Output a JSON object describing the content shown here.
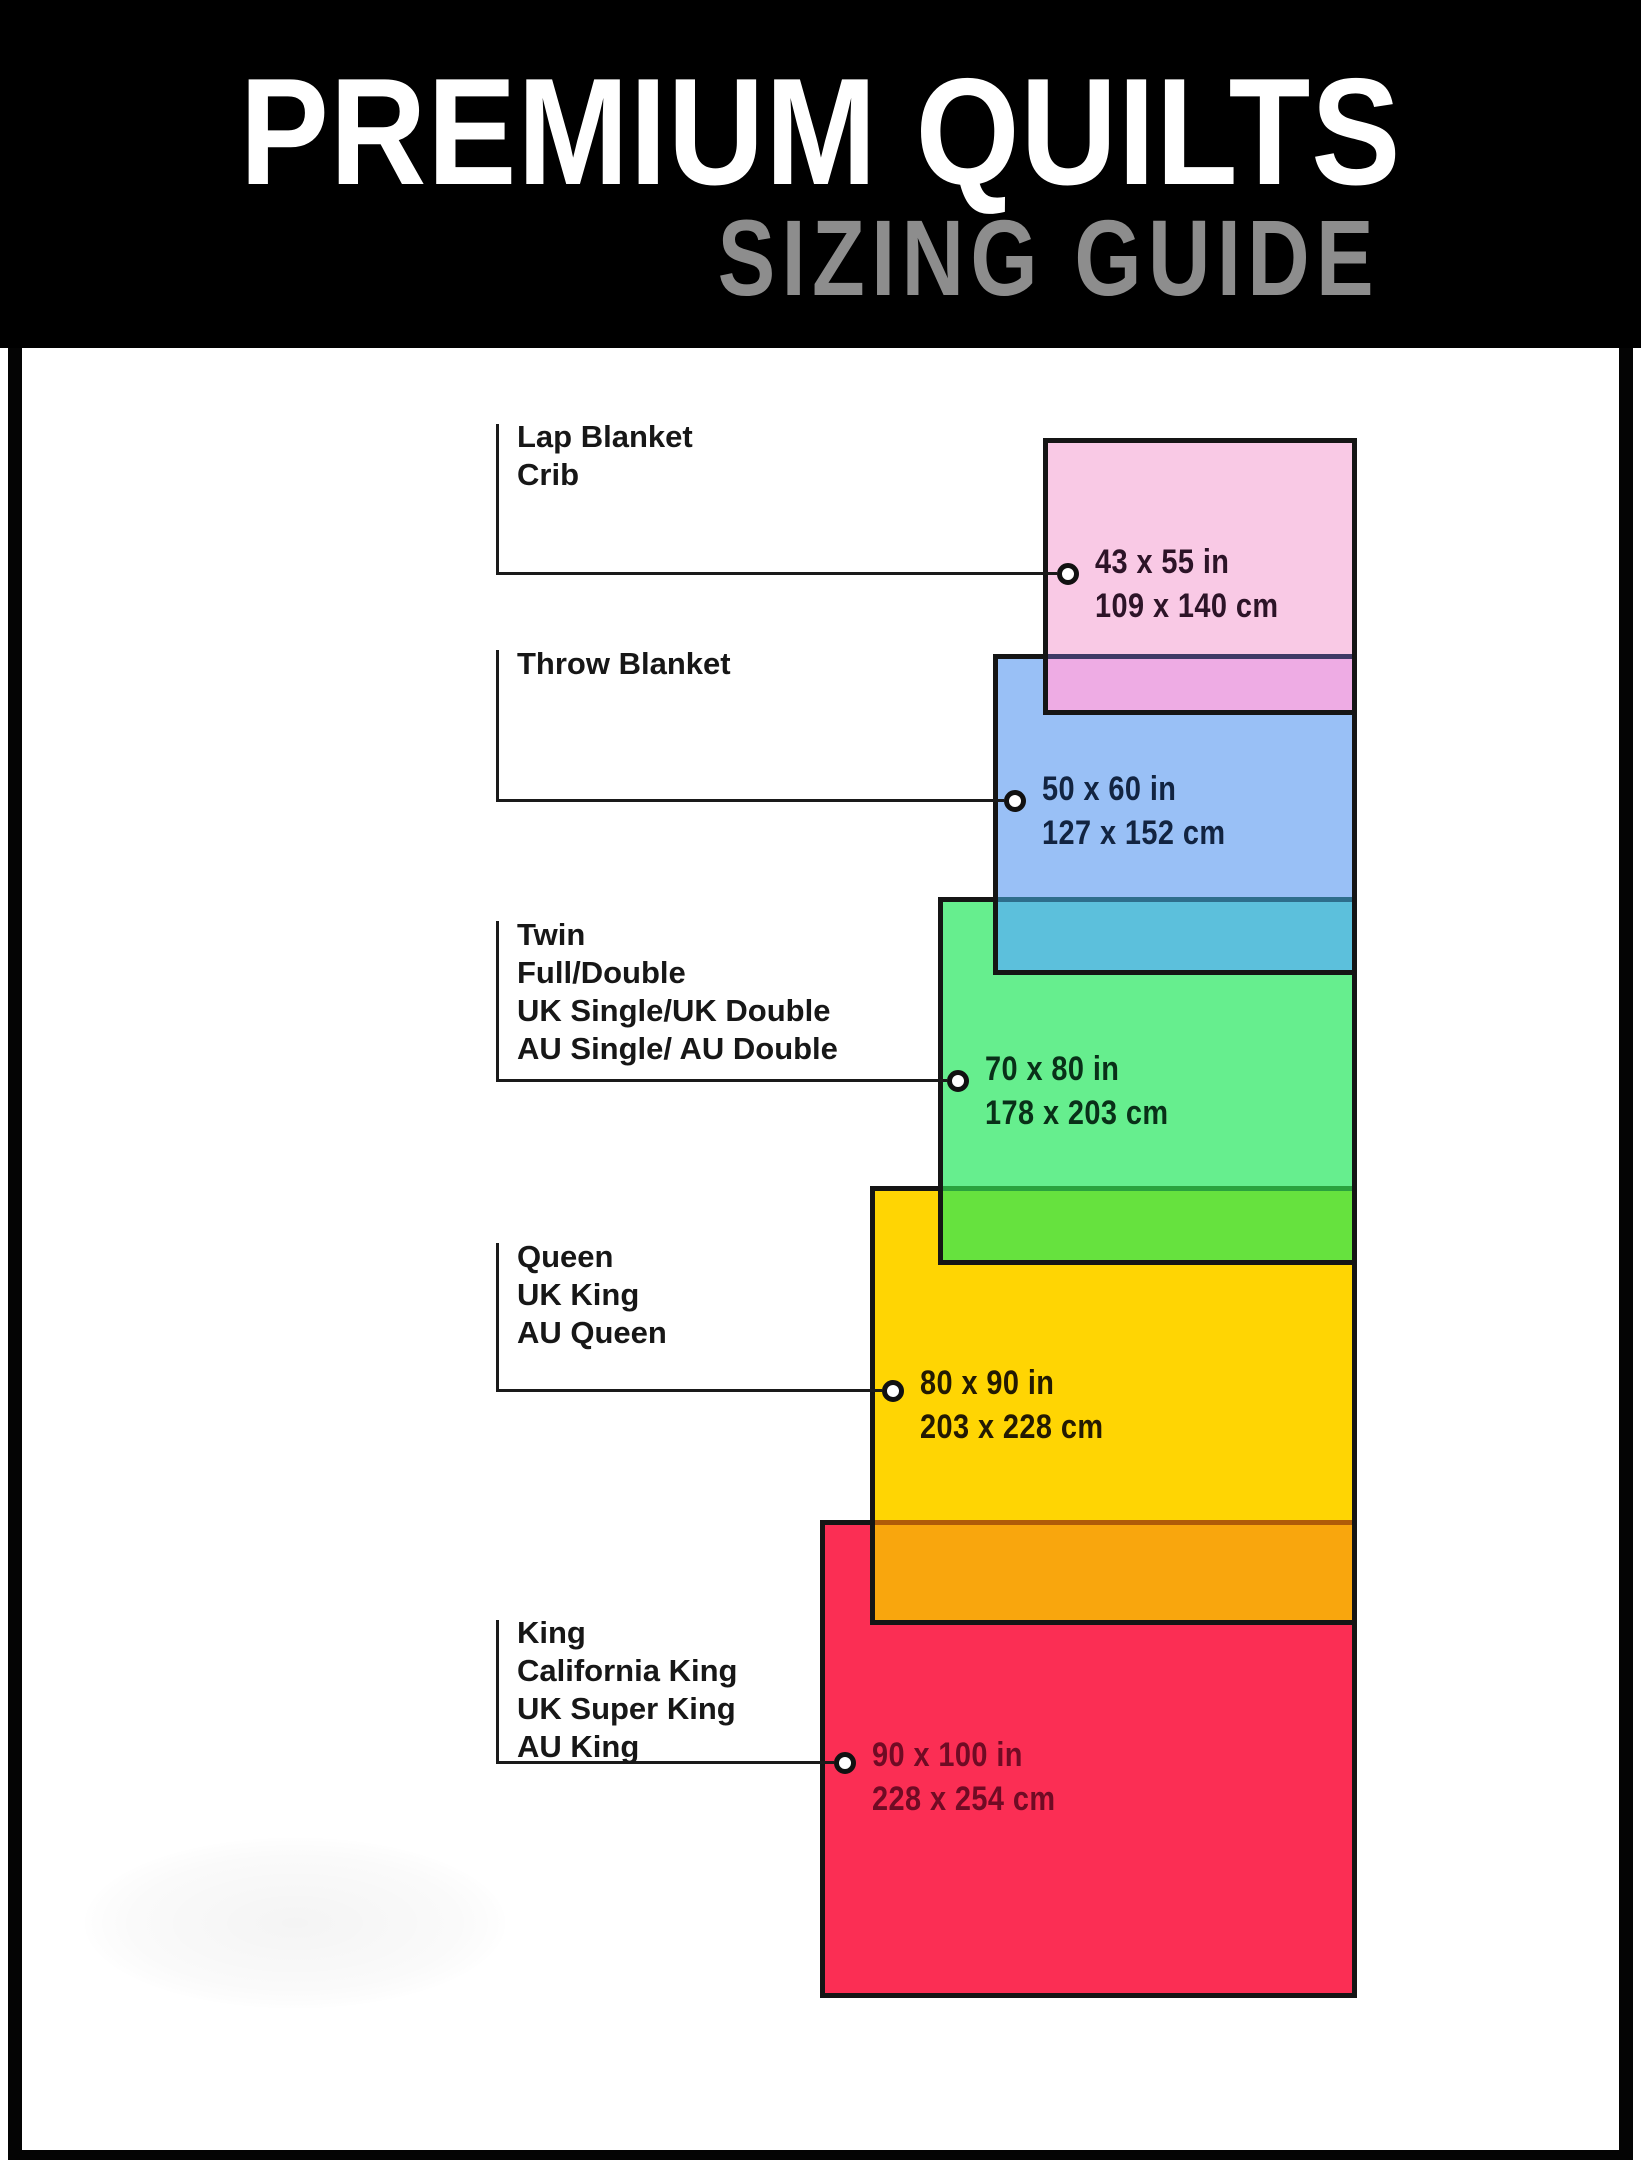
{
  "header": {
    "title": "PREMIUM QUILTS",
    "subtitle": "SIZING GUIDE",
    "bg_color": "#000000",
    "title_color": "#ffffff",
    "subtitle_color": "#8d8d8d"
  },
  "frame_color": "#040404",
  "connector_color": "#1a1a1a",
  "outline_color": "#151515",
  "quilts": [
    {
      "id": "lap-blanket-crib",
      "labels": [
        "Lap Blanket",
        "Crib"
      ],
      "size_in": "43 x 55 in",
      "size_cm": "109 x 140 cm",
      "fill": "#f9c9e5",
      "text_color": "#2d1428",
      "overlap_fill": "#eeace4",
      "overlap_line": "#3f3a66"
    },
    {
      "id": "throw-blanket",
      "labels": [
        "Throw Blanket"
      ],
      "size_in": "50 x 60 in",
      "size_cm": "127 x 152 cm",
      "fill": "#99c0f6",
      "text_color": "#122441",
      "overlap_fill": "#5cc0dc",
      "overlap_line": "#2e6e8c"
    },
    {
      "id": "twin-full-double",
      "labels": [
        "Twin",
        "Full/Double",
        "UK Single/UK Double",
        "AU Single/ AU Double"
      ],
      "size_in": "70 x 80 in",
      "size_cm": "178 x 203 cm",
      "fill": "#66ee8e",
      "text_color": "#093018",
      "overlap_fill": "#66e23e",
      "overlap_line": "#2aa23e"
    },
    {
      "id": "queen",
      "labels": [
        "Queen",
        "UK King",
        "AU Queen"
      ],
      "size_in": "80 x 90 in",
      "size_cm": "203 x 228 cm",
      "fill": "#ffd503",
      "text_color": "#231a02",
      "overlap_fill": "#f9a60d",
      "overlap_line": "#b05b08"
    },
    {
      "id": "king-cal-king",
      "labels": [
        "King",
        "California King",
        "UK Super King",
        "AU King"
      ],
      "size_in": "90 x 100 in",
      "size_cm": "228 x 254 cm",
      "fill": "#fb2e54",
      "text_color": "#6f0b24",
      "overlap_fill": null,
      "overlap_line": null
    }
  ]
}
